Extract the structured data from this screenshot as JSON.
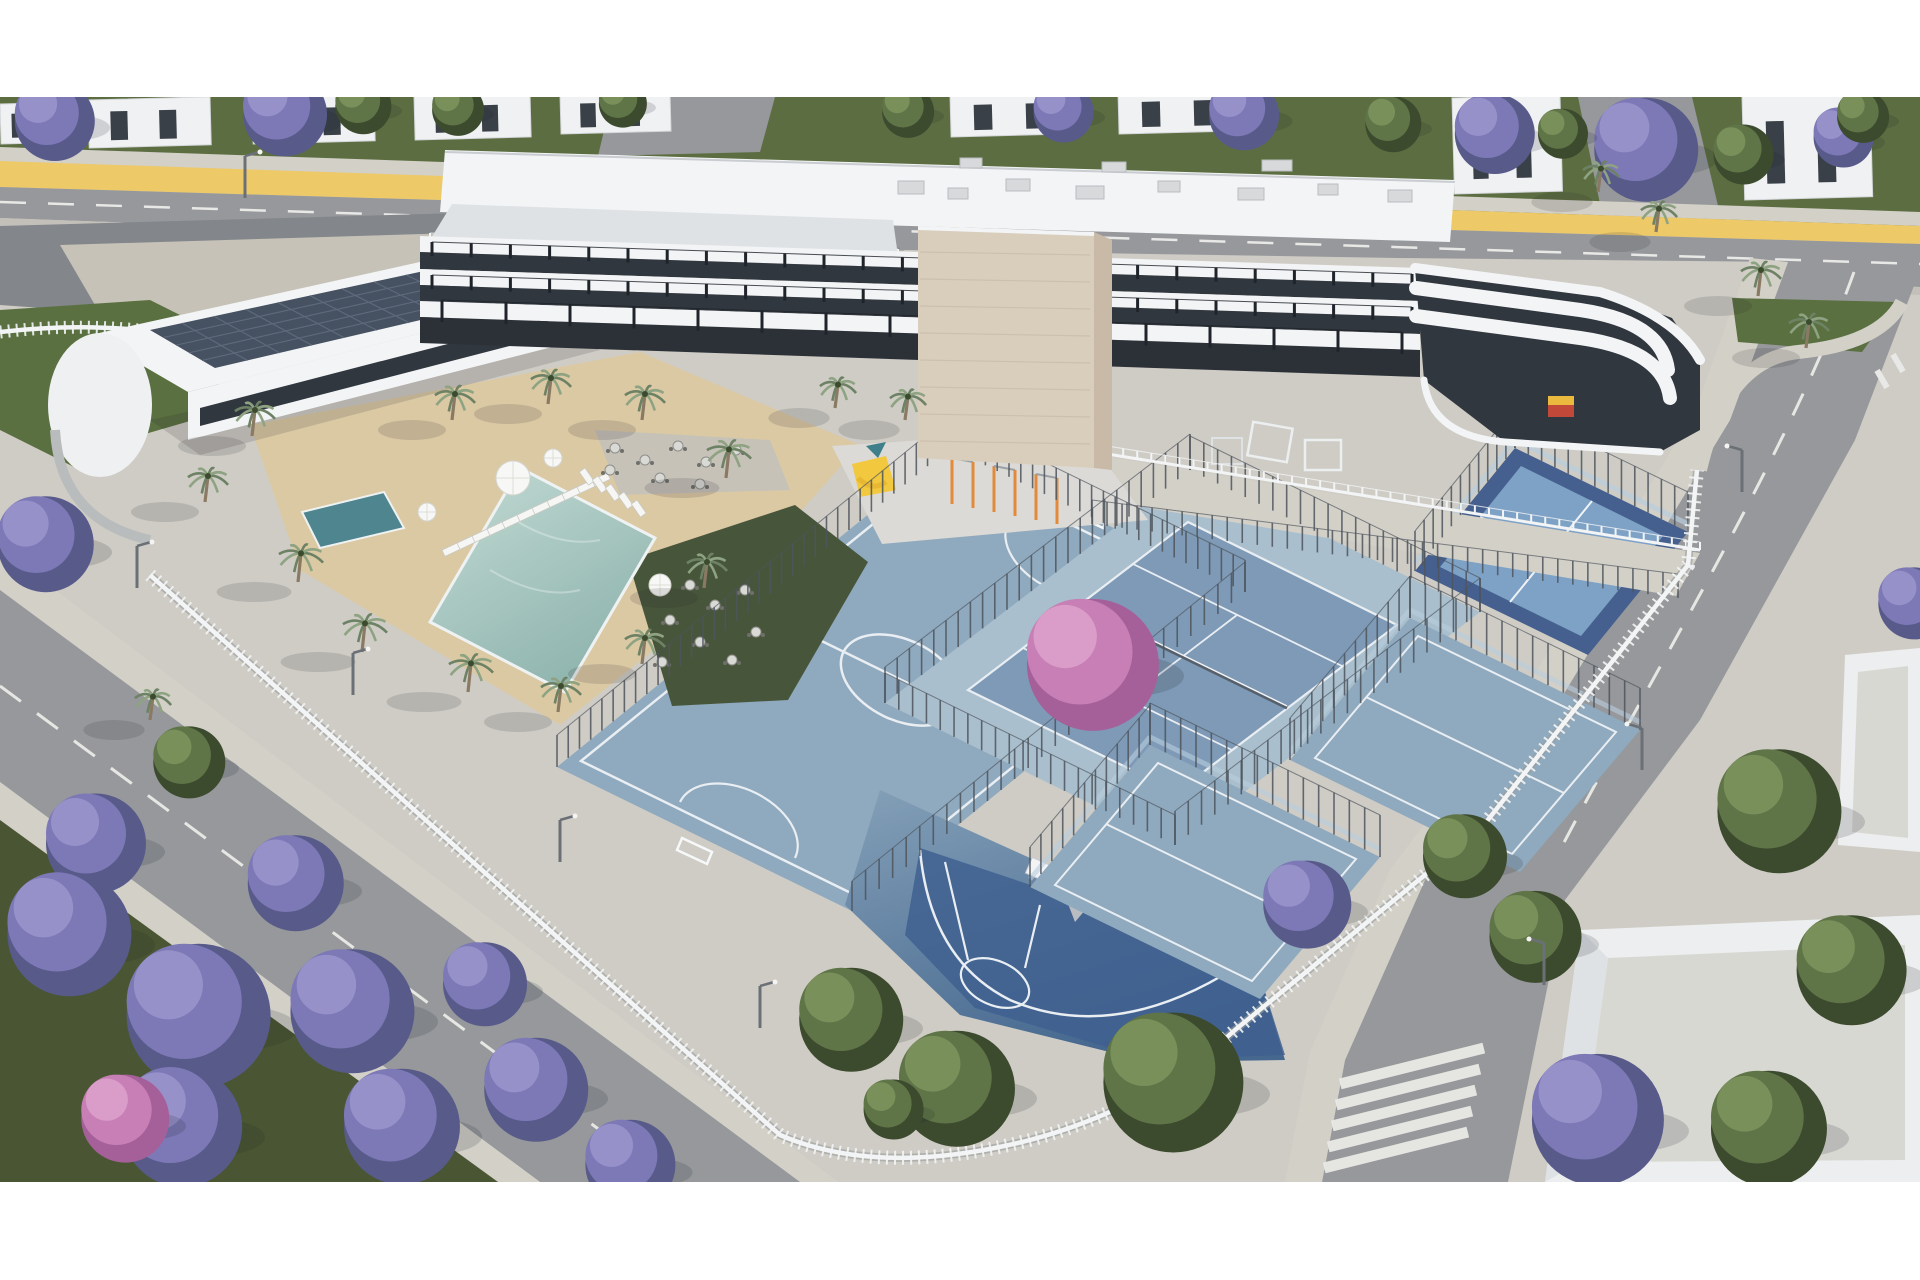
{
  "meta": {
    "title": "Aerial 3D architectural rendering of a residential complex with apartment building, pool courtyard and sports courts",
    "type": "exterior-render",
    "letterbox_top_px": 97,
    "letterbox_bottom_px": 98
  },
  "palette": {
    "white": "#ffffff",
    "asphalt": "#96989b",
    "asphalt_dark": "#83868a",
    "sidewalk": "#d3d0c8",
    "paver": "#c6c2b8",
    "paver_light": "#cfccc5",
    "curb": "#c3c0ba",
    "yellow_path": "#edc968",
    "grass_top": "#5c6e41",
    "lawn": "#5a7040",
    "grass_dark": "#47553a",
    "verge_grass": "#4a5633",
    "jacaranda": "#7d78b6",
    "jacaranda_dark": "#585a8a",
    "jacaranda_light": "#9a94cc",
    "pink_tree": "#c77fb5",
    "pink_dark": "#a5609a",
    "green_tree": "#5f7547",
    "green_dark": "#3c4a2e",
    "green_light": "#7c935d",
    "palm": "#8ea382",
    "palm_dark": "#6d8265",
    "trunk": "#8a7a63",
    "sand": "#dbc9a4",
    "pool_light": "#bcd6cf",
    "pool_deep": "#8fb4ae",
    "spa": "#4f858e",
    "court": "#8fa9be",
    "court_light": "#a9bfcd",
    "court_inner": "#7e9ab6",
    "court_pale": "#b7c6d2",
    "court_navy": "#3f608f",
    "padel_dark": "#45608e",
    "padel_light": "#7ea1c6",
    "glass": "#b9cede",
    "line_white": "#e9eef3",
    "bldg_white": "#f3f4f6",
    "bldg_shade": "#dfe2e5",
    "bldg_dark": "#31373e",
    "bldg_ground": "#2c3138",
    "stone": "#d9cdbc",
    "stone_shade": "#c8baa7",
    "solar": "#465161",
    "solar_line": "#5c6a7c",
    "fence_white": "#f2f4f5",
    "fence_dark": "#4e555d",
    "orange": "#e2893b",
    "slide_yellow": "#f2c83e",
    "teal": "#3f7f8a",
    "sign_red": "#c2483a",
    "sign_yellow": "#eab93d",
    "gravel": "#d8d8d3",
    "shadow": "#20242e"
  },
  "scene": {
    "trees": {
      "jacaranda": [
        [
          50,
          115,
          40
        ],
        [
          280,
          108,
          42
        ],
        [
          1060,
          108,
          30
        ],
        [
          1240,
          110,
          35
        ],
        [
          1490,
          128,
          40
        ],
        [
          1640,
          142,
          52
        ],
        [
          1840,
          133,
          30
        ],
        [
          40,
          537,
          48
        ],
        [
          90,
          836,
          50
        ],
        [
          290,
          876,
          48
        ],
        [
          62,
          925,
          62
        ],
        [
          190,
          1005,
          72
        ],
        [
          345,
          1002,
          62
        ],
        [
          480,
          978,
          42
        ],
        [
          175,
          1118,
          60
        ],
        [
          395,
          1118,
          58
        ],
        [
          530,
          1082,
          52
        ],
        [
          625,
          1158,
          45
        ],
        [
          1302,
          898,
          44
        ],
        [
          1590,
          1110,
          66
        ],
        [
          1910,
          598,
          36
        ]
      ],
      "pink": [
        [
          1085,
          655,
          66
        ],
        [
          120,
          1112,
          44
        ]
      ],
      "green": [
        [
          360,
          102,
          28
        ],
        [
          455,
          106,
          26
        ],
        [
          620,
          100,
          24
        ],
        [
          905,
          108,
          26
        ],
        [
          1390,
          120,
          28
        ],
        [
          1560,
          130,
          25
        ],
        [
          1740,
          150,
          30
        ],
        [
          1860,
          113,
          26
        ],
        [
          185,
          757,
          36
        ],
        [
          845,
          1012,
          52
        ],
        [
          950,
          1080,
          58
        ],
        [
          1165,
          1072,
          70
        ],
        [
          890,
          1105,
          30
        ],
        [
          1460,
          850,
          42
        ],
        [
          1530,
          930,
          46
        ],
        [
          1772,
          802,
          62
        ],
        [
          1845,
          962,
          55
        ],
        [
          1762,
          1120,
          58
        ]
      ]
    },
    "palms": [
      [
        252,
        436,
        1
      ],
      [
        205,
        502,
        1
      ],
      [
        298,
        582,
        1.1
      ],
      [
        362,
        652,
        1.1
      ],
      [
        468,
        692,
        1.1
      ],
      [
        558,
        712,
        1
      ],
      [
        642,
        664,
        1
      ],
      [
        704,
        588,
        1
      ],
      [
        726,
        478,
        1.1
      ],
      [
        642,
        420,
        1
      ],
      [
        548,
        404,
        1
      ],
      [
        452,
        420,
        1
      ],
      [
        150,
        720,
        0.9
      ],
      [
        1598,
        192,
        0.9
      ],
      [
        1656,
        232,
        0.9
      ],
      [
        1758,
        296,
        1
      ],
      [
        1806,
        348,
        1
      ],
      [
        905,
        420,
        0.9
      ],
      [
        835,
        408,
        0.9
      ]
    ],
    "lounger_rows": [
      {
        "x": 442,
        "y": 550,
        "dx": 15,
        "dy": -7,
        "n": 11,
        "w": 17,
        "h": 7,
        "rot": -25
      },
      {
        "x": 585,
        "y": 468,
        "dx": 13,
        "dy": 8,
        "n": 5,
        "w": 16,
        "h": 7,
        "rot": 55
      }
    ],
    "umbrellas": [
      [
        513,
        478,
        17
      ],
      [
        427,
        512,
        9
      ],
      [
        553,
        458,
        9
      ],
      [
        660,
        585,
        11
      ]
    ],
    "tables": [
      [
        615,
        448
      ],
      [
        645,
        460
      ],
      [
        678,
        446
      ],
      [
        706,
        462
      ],
      [
        736,
        450
      ],
      [
        660,
        478
      ],
      [
        700,
        484
      ],
      [
        610,
        470
      ],
      [
        690,
        585
      ],
      [
        715,
        605
      ],
      [
        745,
        590
      ],
      [
        670,
        620
      ],
      [
        700,
        642
      ],
      [
        732,
        660
      ],
      [
        662,
        662
      ],
      [
        756,
        632
      ]
    ],
    "fences_dark": [
      [
        557,
        767,
        950,
        448,
        36,
        32
      ],
      [
        950,
        448,
        1245,
        592,
        26,
        32
      ],
      [
        885,
        703,
        1190,
        470,
        26,
        36
      ],
      [
        1245,
        592,
        852,
        911,
        30,
        30
      ],
      [
        1190,
        470,
        1480,
        612,
        22,
        34
      ],
      [
        1480,
        612,
        1175,
        845,
        24,
        34
      ],
      [
        885,
        703,
        1175,
        845,
        22,
        30
      ],
      [
        1030,
        887,
        1150,
        745,
        12,
        40
      ],
      [
        1150,
        745,
        1380,
        857,
        16,
        42
      ],
      [
        1290,
        760,
        1410,
        618,
        12,
        42
      ],
      [
        1410,
        618,
        1640,
        730,
        16,
        42
      ],
      [
        1415,
        571,
        1515,
        448,
        12,
        40
      ],
      [
        1515,
        448,
        1688,
        532,
        14,
        40
      ],
      [
        1092,
        524,
        1678,
        598,
        40,
        24
      ]
    ],
    "fences_white": [
      [
        430,
        240,
        898,
        256,
        44,
        7
      ],
      [
        1095,
        452,
        1700,
        550,
        44,
        8
      ]
    ],
    "mullions": [
      [
        432,
        256,
        1412,
        288,
        26,
        14
      ],
      [
        432,
        289,
        1412,
        321,
        26,
        14
      ],
      [
        442,
        322,
        1402,
        354,
        16,
        22
      ]
    ],
    "lamps": [
      [
        137,
        588,
        1
      ],
      [
        353,
        695,
        1
      ],
      [
        560,
        862,
        1
      ],
      [
        760,
        1028,
        1
      ],
      [
        1742,
        492,
        -1
      ],
      [
        1642,
        770,
        -1
      ],
      [
        1544,
        985,
        -1
      ],
      [
        245,
        198,
        1
      ]
    ],
    "houses": [
      [
        0,
        104,
        62,
        40
      ],
      [
        88,
        100,
        122,
        48
      ],
      [
        252,
        98,
        122,
        46
      ],
      [
        414,
        96,
        116,
        44
      ],
      [
        560,
        94,
        110,
        40
      ],
      [
        950,
        95,
        130,
        42
      ],
      [
        1118,
        92,
        130,
        42
      ],
      [
        1452,
        98,
        108,
        96
      ],
      [
        1742,
        96,
        128,
        104
      ]
    ],
    "rooftop_units": [
      [
        898,
        181,
        26,
        13
      ],
      [
        948,
        188,
        20,
        11
      ],
      [
        1006,
        179,
        24,
        12
      ],
      [
        1076,
        186,
        28,
        13
      ],
      [
        1158,
        181,
        22,
        11
      ],
      [
        1238,
        188,
        26,
        12
      ],
      [
        1318,
        184,
        20,
        11
      ],
      [
        1388,
        190,
        24,
        12
      ],
      [
        1262,
        160,
        30,
        11
      ],
      [
        1102,
        162,
        24,
        10
      ],
      [
        960,
        158,
        22,
        10
      ]
    ],
    "crosswalk": {
      "cx": 1412,
      "cy": 1066,
      "dx": -4,
      "dy": 21,
      "n": 5,
      "w": 148,
      "h": 11,
      "rot": -14
    },
    "gym": {
      "posts": [
        [
          952,
          458
        ],
        [
          973,
          462
        ],
        [
          994,
          466
        ],
        [
          1015,
          470
        ],
        [
          1036,
          474
        ],
        [
          1057,
          478
        ]
      ],
      "post_h": 46
    },
    "solar": {
      "a": [
        150,
        330
      ],
      "b": [
        438,
        268
      ],
      "c": [
        506,
        300
      ],
      "d": [
        215,
        368
      ],
      "rows": 4,
      "cols": 8
    },
    "tower_joints": {
      "x1": 920,
      "x2": 1090,
      "y0": 252,
      "dy": 27,
      "n": 8
    }
  }
}
